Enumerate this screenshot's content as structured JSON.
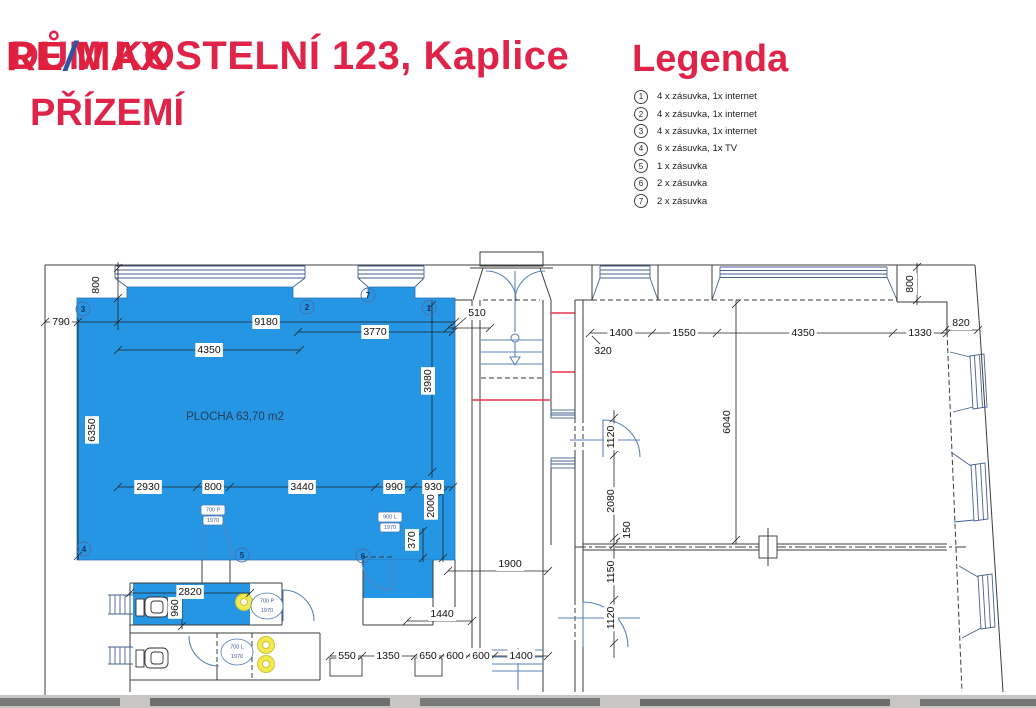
{
  "title": {
    "logo_re": "RE",
    "logo_slash": "/",
    "logo_max": "MAX",
    "address": "DŮM KOSTELNÍ 123, Kaplice",
    "floor": "PŘÍZEMÍ"
  },
  "legend": {
    "heading": "Legenda",
    "items": [
      {
        "num": "1",
        "text": "4 x zásuvka, 1x internet"
      },
      {
        "num": "2",
        "text": "4 x zásuvka, 1x internet"
      },
      {
        "num": "3",
        "text": "4 x zásuvka, 1x internet"
      },
      {
        "num": "4",
        "text": "6 x zásuvka, 1x TV"
      },
      {
        "num": "5",
        "text": "1 x zásuvka"
      },
      {
        "num": "6",
        "text": "2 x zásuvka"
      },
      {
        "num": "7",
        "text": "2 x zásuvka"
      }
    ]
  },
  "plan": {
    "area_label": "PLOCHA 63,70 m2",
    "markers": [
      "1",
      "2",
      "3",
      "4",
      "5",
      "6",
      "7"
    ],
    "door_tags": [
      {
        "size": "700 P",
        "height": "1970"
      },
      {
        "size": "900 L",
        "height": "1970"
      },
      {
        "size": "700 P",
        "height": "1970"
      },
      {
        "size": "700 L",
        "height": "1970"
      }
    ],
    "dims": {
      "top_790": "790",
      "top_9180": "9180",
      "top_4350": "4350",
      "top_3770": "3770",
      "top_510": "510",
      "top_800_left": "800",
      "top_800_right": "800",
      "left_6350": "6350",
      "right_3980": "3980",
      "bottom_2930": "2930",
      "bottom_800": "800",
      "bottom_3440": "3440",
      "bottom_990": "990",
      "bottom_930": "930",
      "right_2000": "2000",
      "right_370": "370",
      "wc_2820": "2820",
      "wc_960": "960",
      "mid_1900": "1900",
      "mid_1440": "1440",
      "row_550": "550",
      "row_1350": "1350",
      "row_650": "650",
      "row_600a": "600",
      "row_600b": "600",
      "row_1400": "1400",
      "r_top_1400": "1400",
      "r_top_1550": "1550",
      "r_top_4350": "4350",
      "r_top_1330": "1330",
      "r_top_820": "820",
      "r_top_320": "320",
      "r_left_1120a": "1120",
      "r_left_2080": "2080",
      "r_left_150": "150",
      "r_left_1150": "1150",
      "r_left_1120b": "1120",
      "r_mid_6040": "6040"
    }
  },
  "colors": {
    "accent_red": "#e02449",
    "logo_blue": "#2b55a5",
    "room_blue": "#2596e3",
    "line_blue": "#5b83b8",
    "cut_red": "#e8344a",
    "fixture_yellow": "#f2ea4e"
  }
}
